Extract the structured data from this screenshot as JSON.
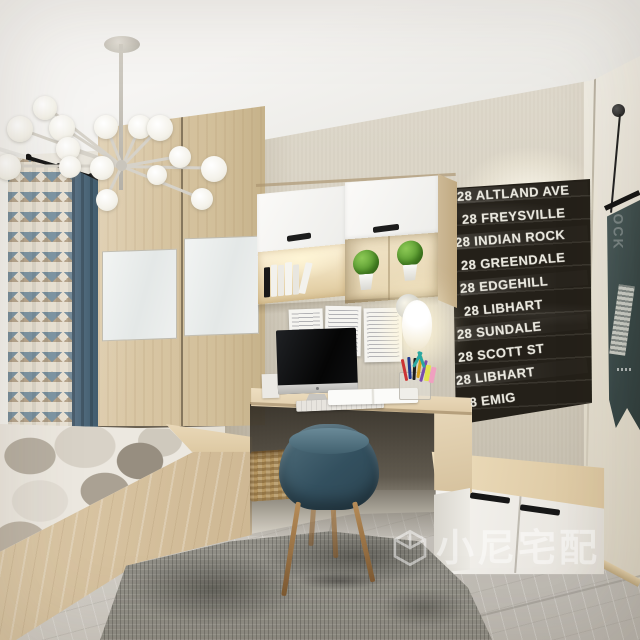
{
  "scene": {
    "description": "3D interior render of a small bedroom-study: tatami platform bed, sliding-door wardrobe, built-in desk nook, chalkboard street-sign art and hanging pennant",
    "room_type": "bedroom study",
    "style": "modern light-wood"
  },
  "colors": {
    "ceiling": "#f4f3f0",
    "back_wall": "#dbd5c7",
    "right_wall": "#ece8dd",
    "wood_light": "#ddcaa8",
    "wood_mid": "#cdb691",
    "white_panel": "#f2f0ec",
    "chalkboard_bg": "#242019",
    "chalk_text": "#e9e7de",
    "chair_blue": "#3c5868",
    "curtain_blue": "#52707f",
    "curtain_chevron_tan": "#b7a68e",
    "curtain_chevron_blue": "#7d95a4",
    "rug_grey": "#908e86",
    "floor_marble": "#c9c5be",
    "plant_green": "#57992e",
    "basket_tan": "#b3945f",
    "warm_glow": "#ffe9bd"
  },
  "chalkboard": {
    "lines": [
      "28 ALTLAND AVE",
      "28 FREYSVILLE",
      "28 INDIAN ROCK",
      "28 GREENDALE",
      "28 EDGEHILL",
      "28 LIBHART",
      "28 SUNDALE",
      "28 SCOTT ST",
      "28 LIBHART",
      "28 EMIG"
    ]
  },
  "banner": {
    "visible_text": "OCK"
  },
  "watermark": {
    "icon": "cube-logo-icon",
    "text": "小尼宅配"
  },
  "objects": {
    "chandelier": "branching globe chandelier",
    "wardrobe": "sliding-door wardrobe with mirror panels",
    "curtains": "chevron and solid blue curtains with black rod",
    "bed": "tatami platform bed with pebble-pattern topper",
    "desk": "built-in light wood desk",
    "chair": "blue upholstered chair with wood legs",
    "computer": "all-in-one monitor with white keyboard",
    "wall_cabinet": "wall cabinet, white doors and lit open shelves",
    "plants": "two potted topiary balls",
    "sconce": "glowing oval wall lamp",
    "notes": "three pinned handwritten notes",
    "basket": "wicker storage basket",
    "bench_cabinet": "low storage bench with white doors",
    "rug": "distressed grey rug",
    "banner": "teal hanging pennant on right wall"
  }
}
